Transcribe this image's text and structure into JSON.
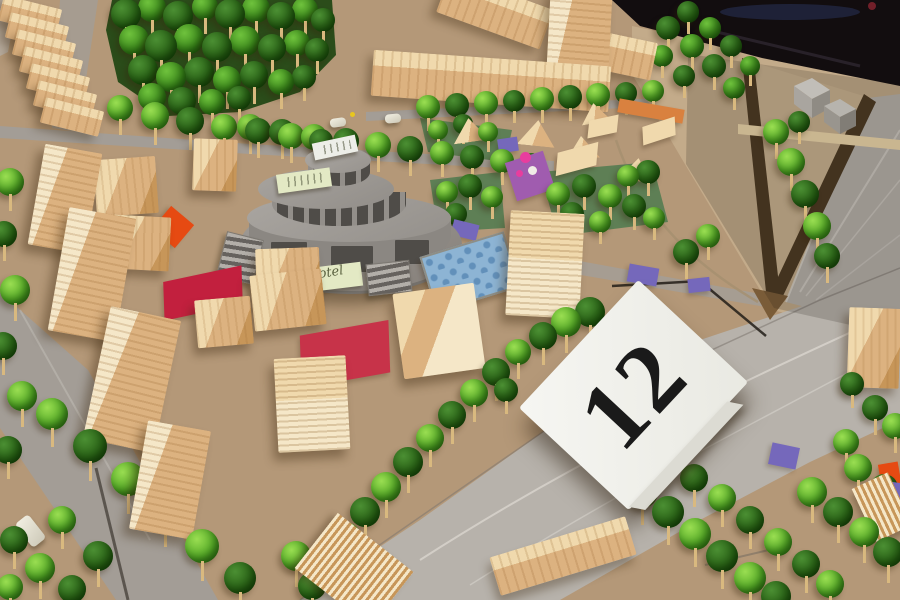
{
  "scene": {
    "description": "Architectural scale model: cardboard base, wooden block buildings, crumpled green paper trees, circular tiered cardboard hotel, felt plazas, roads and a folded entry card",
    "card": {
      "number": "12"
    },
    "notes": {
      "tier1": "Hotel"
    }
  },
  "palette": {
    "base": "#b49878",
    "beige": "#c3ab8a",
    "beige2": "#cbb492",
    "road_light": "#b7b2ab",
    "road_mid": "#a39d96",
    "road_dark": "#7d7770",
    "seam": "#4a443d",
    "lane": "#e8e5df",
    "wood_top": "#f0d9ad",
    "wood_front": "#dcb280",
    "wood_side": "#c79659",
    "wood_pale": "#f5e7c8",
    "stick": "#d9b97f",
    "park": "#5e7f55",
    "hedge": "#4c3a23",
    "hedge2": "#7a5c38",
    "felt_red": "#c2203e",
    "felt_red2": "#c73349",
    "felt_orange": "#e64a12",
    "felt_purple": "#7568bb",
    "felt_magenta": "#a05caf",
    "flower_pink": "#e83d9e",
    "blue_patch": "#8db4d4",
    "blue_dot": "#6290ba",
    "note": "#e3e9c4",
    "card": "#f4f4f0",
    "digit": "#1a1a1a",
    "dark": "#120d0f",
    "gray_roof": "#a5a19c",
    "gray_wall": "#8b8782",
    "gray_dark": "#4f4c48",
    "plinth": "#99958f",
    "plinth_wall": "#74706b"
  }
}
